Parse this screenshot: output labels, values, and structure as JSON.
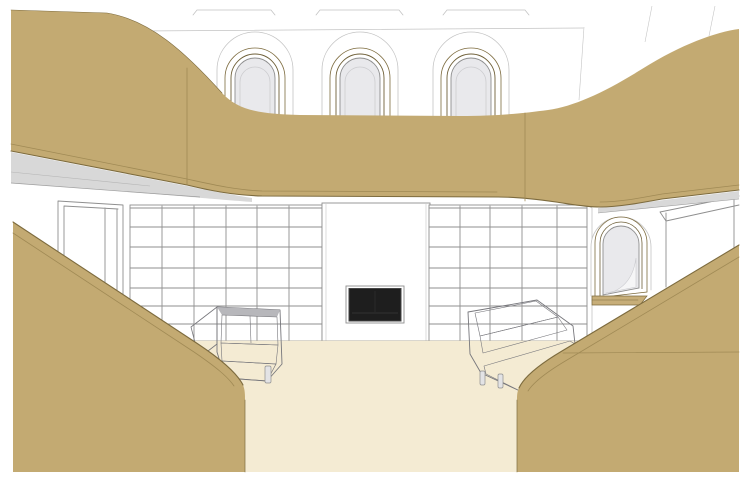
{
  "scene": {
    "title": "3D interior rendering: library lounge with arched clerestory windows, shelving wall, fireplace and curved tan pods",
    "objects": {
      "ceiling": "Ceiling with three skylight well marks",
      "arched_window_1": "Arched clerestory window (left)",
      "arched_window_2": "Arched clerestory window (center)",
      "arched_window_3": "Arched clerestory window (right)",
      "canopy": "Curved tan upper canopy / mezzanine band",
      "soffit_left": "Grey soffit under canopy (left)",
      "soffit_right": "Grey soffit under canopy (right)",
      "door_left": "Open doorway on left wall",
      "bookshelf_left": "Empty shelving grid, left of fireplace",
      "bookshelf_right": "Empty shelving grid, right of fireplace",
      "chimney": "White chimney breast panel",
      "fireplace": "Recessed black fireplace opening",
      "niche_right": "Arched niche on right wall",
      "door_right": "Doorway panel on right wall",
      "floor": "Cream floor",
      "sofa_left": "Grey sofa (left)",
      "sofa_right": "Grey sofa (right)",
      "pod_left": "Curved tan foreground pod (left)",
      "pod_right": "Curved tan foreground pod (right)"
    },
    "counts": {
      "arched_windows": 3,
      "sofas": 2,
      "shelf_rows": 7,
      "shelf_columns_left": 6,
      "shelf_columns_right": 5
    }
  },
  "colors": {
    "wall": "#ffffff",
    "tan": "#c3aa72",
    "tan_frame": "#c7ae79",
    "tan_edge": "#7d6b3e",
    "tan_seam": "#a08a55",
    "frame_dark": "#6f6039",
    "soffit": "#d8d8d8",
    "line": "#8f8f8f",
    "faint": "#c4c4c4",
    "glazing": "#e9e9ec",
    "glazing_line": "#cccccf",
    "floor": "#f4ebd3",
    "floor_line": "#b3ad9e",
    "sofa_light": "#c8c8cc",
    "sofa_mid": "#b7b7bb",
    "sofa_seat": "#b0b0b4",
    "sofa_outline": "#77777c",
    "leg": "#e3e3e5",
    "firebox": "#1e1e1e"
  }
}
